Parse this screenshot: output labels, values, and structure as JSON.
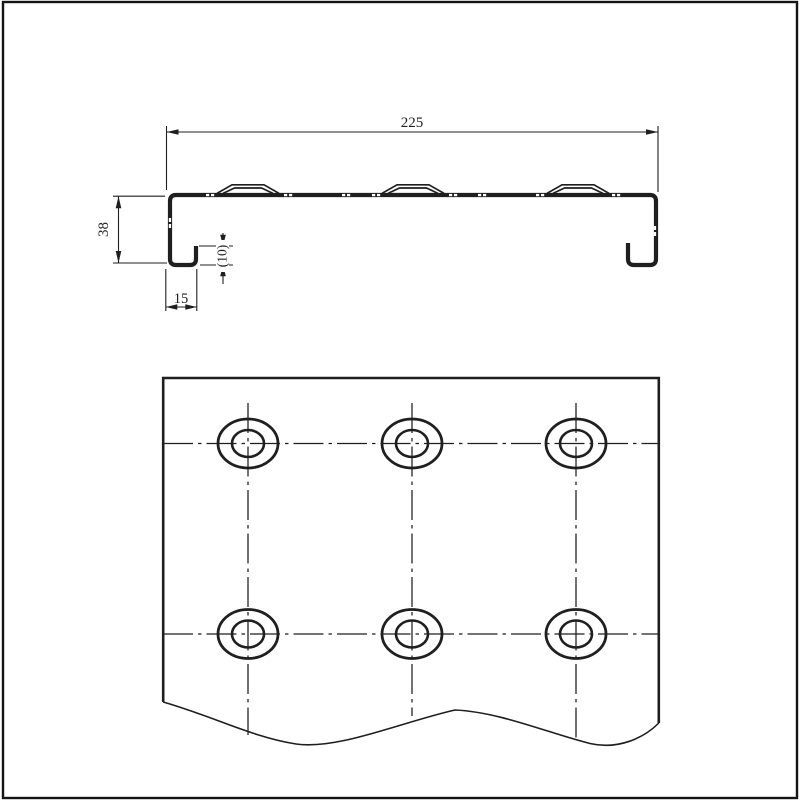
{
  "page": {
    "background": "#ffffff",
    "border_color": "#141414"
  },
  "drawing": {
    "kind": "technical-drawing",
    "line_color": "#1f1f1f",
    "views": {
      "profile_section": {
        "description": "sheet-metal channel cross-section with three embossed ribs and hooked return lips",
        "ribs_count": 3,
        "dimensions": {
          "overall_width": {
            "label": "225",
            "value": 225
          },
          "height": {
            "label": "38",
            "value": 38
          },
          "bottom_return": {
            "label": "15",
            "value": 15
          },
          "lip_height": {
            "label": "(10)",
            "value": 10
          }
        }
      },
      "plan_view": {
        "description": "plate face with hole pattern, broken by wavy break line at bottom",
        "hole_rows": 2,
        "hole_columns": 3,
        "holes_total": 6,
        "hole_style": "two concentric ellipses with dash-dot centerlines",
        "break_line": "wavy"
      }
    }
  }
}
